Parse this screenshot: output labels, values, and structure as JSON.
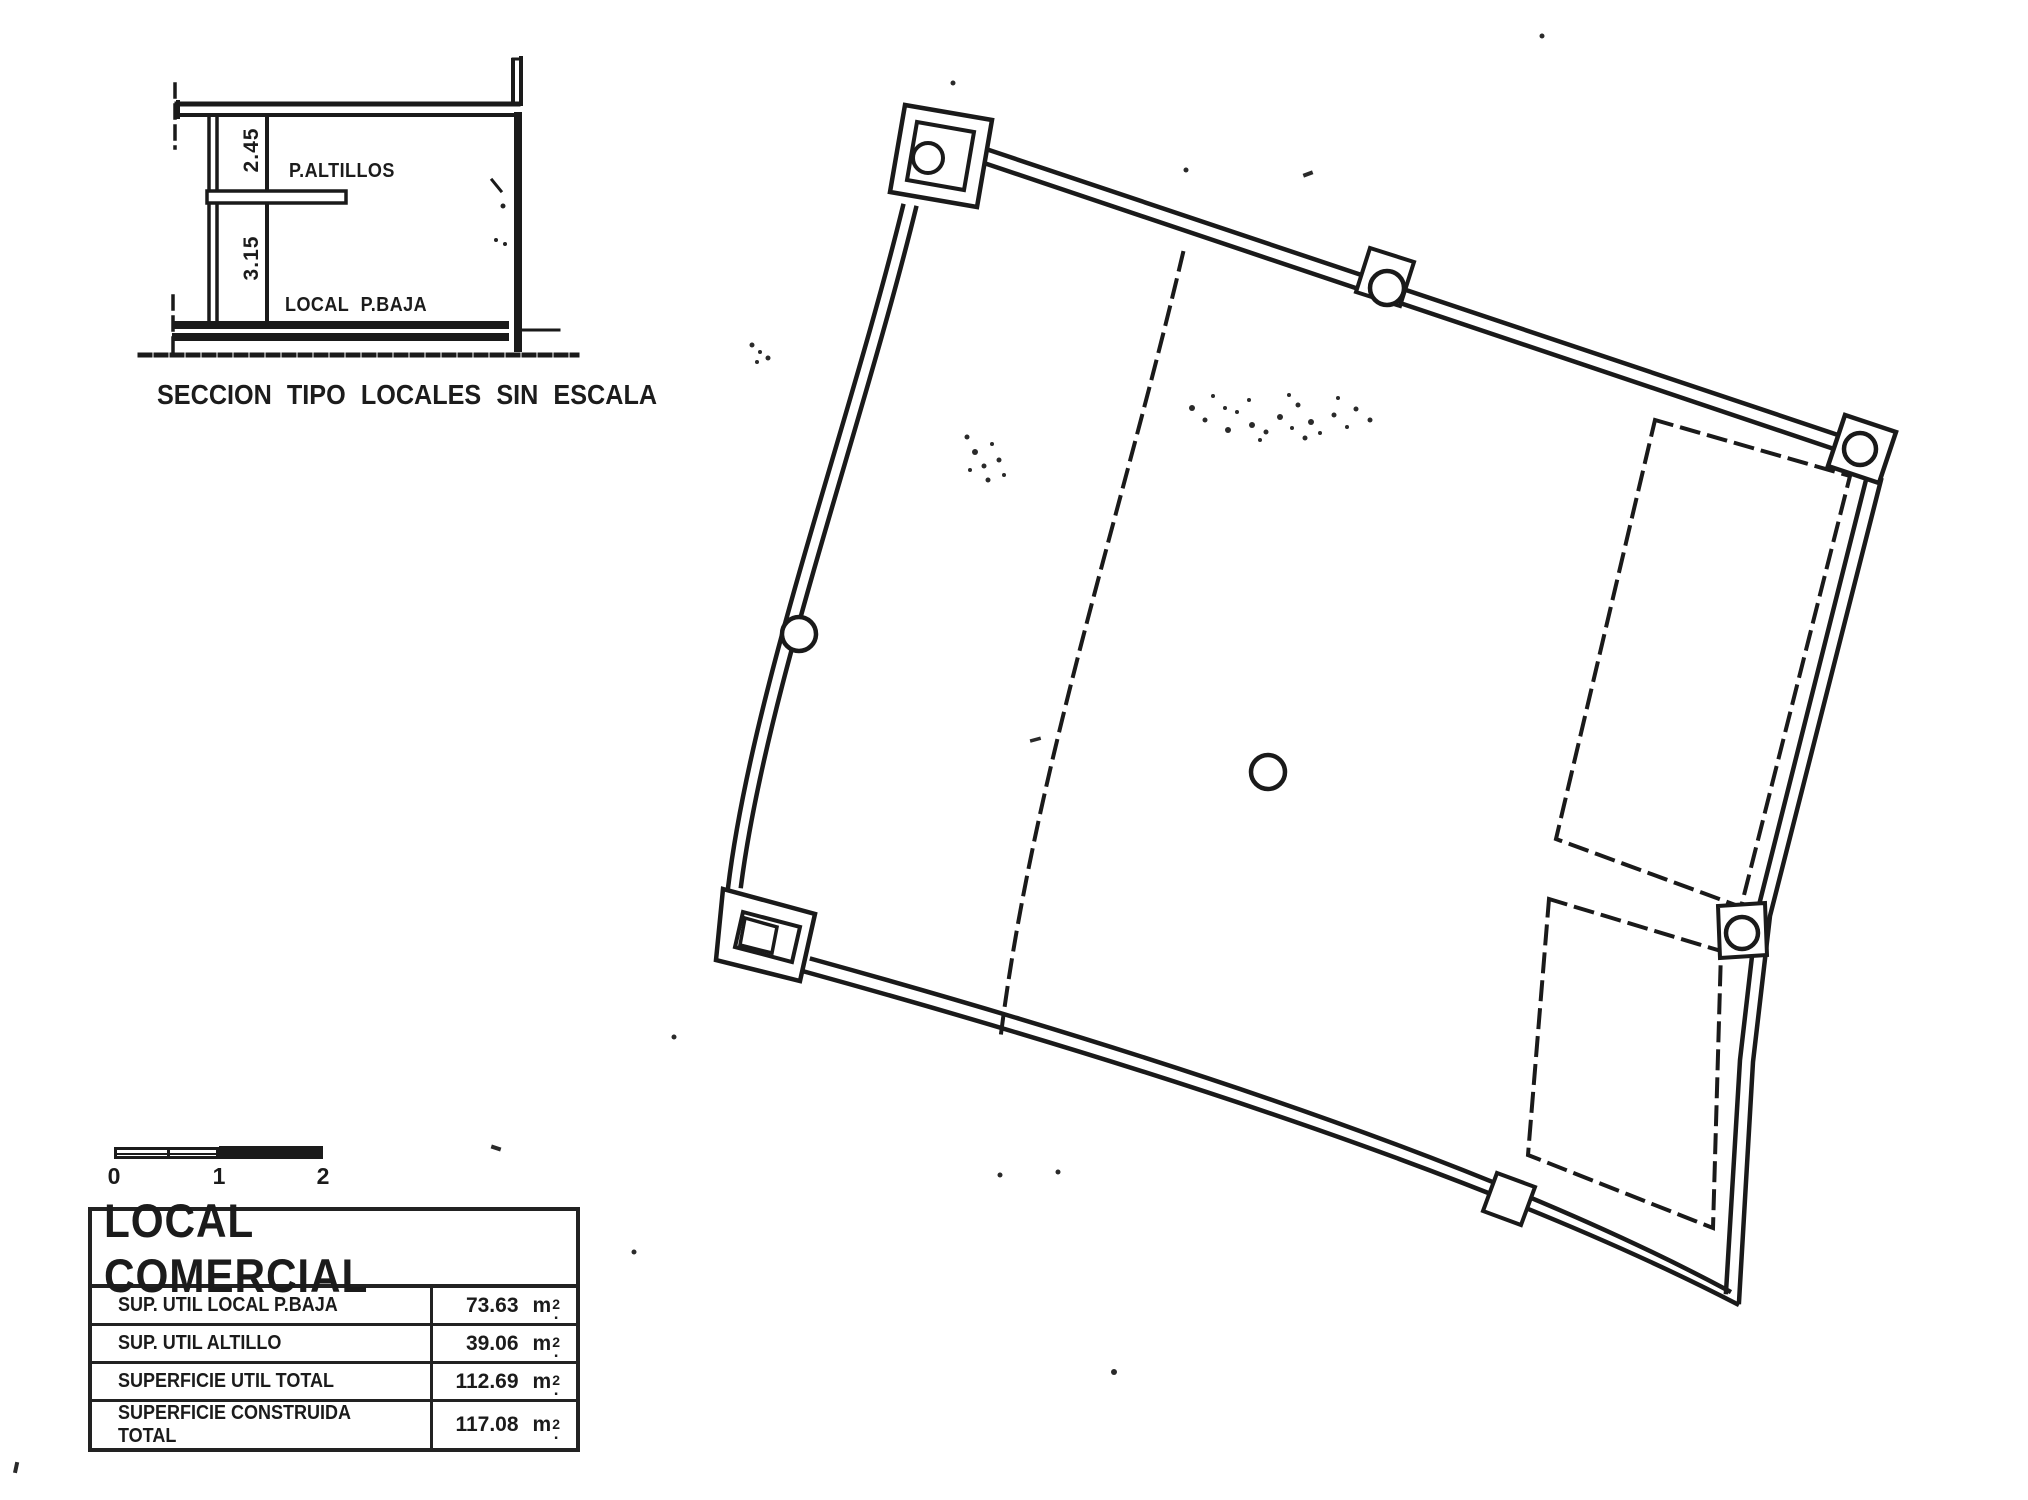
{
  "section": {
    "dim_upper": "2.45",
    "dim_lower": "3.15",
    "label_altillos": "P.ALTILLOS",
    "label_pbaja": "LOCAL P.BAJA",
    "caption": "SECCION TIPO LOCALES SIN ESCALA"
  },
  "scalebar": {
    "labels": [
      "0",
      "1",
      "2"
    ]
  },
  "table": {
    "title": "LOCAL COMERCIAL",
    "unit": {
      "base": "m",
      "exp": "2",
      "dot": "."
    },
    "rows": [
      {
        "label": "SUP. UTIL LOCAL P.BAJA",
        "value": "73.63"
      },
      {
        "label": "SUP. UTIL ALTILLO",
        "value": "39.06"
      },
      {
        "label": "SUPERFICIE UTIL TOTAL",
        "value": "112.69"
      },
      {
        "label": "SUPERFICIE CONSTRUIDA TOTAL",
        "value": "117.08"
      }
    ]
  },
  "colors": {
    "ink": "#1b1b1b",
    "paper": "#ffffff"
  }
}
